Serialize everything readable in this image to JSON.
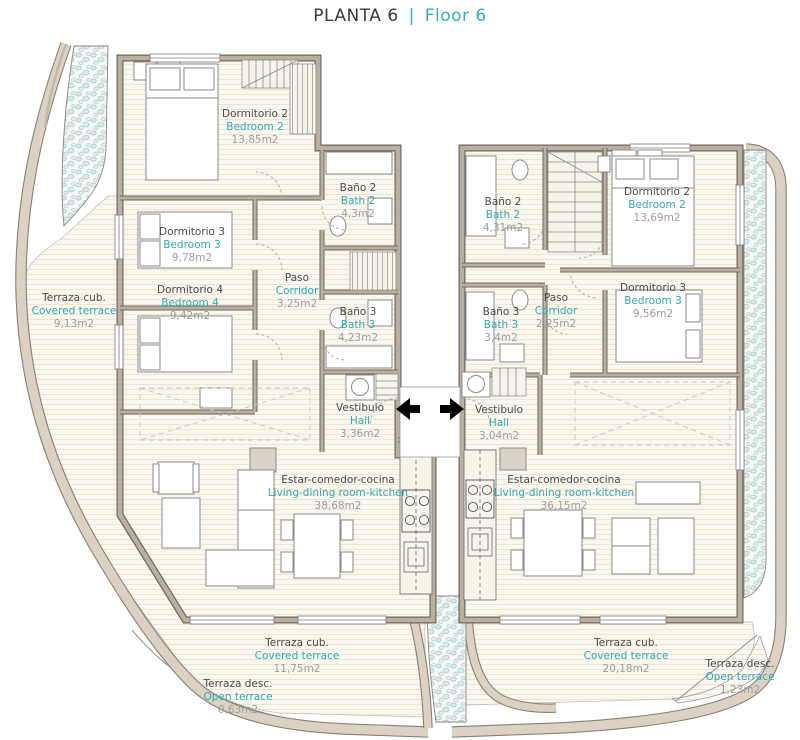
{
  "title": {
    "primary": "PLANTA 6",
    "separator": "|",
    "secondary": "Floor 6"
  },
  "colors": {
    "accent_teal": "#2fa9b2",
    "room_name_gray": "#4a4a4a",
    "area_gray": "#9c9c9c",
    "wall_taupe": "#b9b0a2",
    "band_beige": "#dcd2c3",
    "pebble_blue": "#d9ebe9"
  },
  "icons": {
    "entry_left": "arrow-left",
    "entry_right": "arrow-right"
  },
  "apartment_left": {
    "bedroom2": {
      "es": "Dormitorio 2",
      "en": "Bedroom 2",
      "area": "13,85m2"
    },
    "bedroom3": {
      "es": "Dormitorio 3",
      "en": "Bedroom 3",
      "area": "9,78m2"
    },
    "bedroom4": {
      "es": "Dormitorio 4",
      "en": "Bedroom 4",
      "area": "9,42m2"
    },
    "bath2": {
      "es": "Baño 2",
      "en": "Bath 2",
      "area": "4,3m2"
    },
    "corridor": {
      "es": "Paso",
      "en": "Corridor",
      "area": "3,25m2"
    },
    "bath3": {
      "es": "Baño 3",
      "en": "Bath 3",
      "area": "4,23m2"
    },
    "hall": {
      "es": "Vestibulo",
      "en": "Hall",
      "area": "3,36m2"
    },
    "living": {
      "es": "Estar-comedor-cocina",
      "en": "Living-dining room-kitchen",
      "area": "38,68m2"
    },
    "terrace_side": {
      "es": "Terraza cub.",
      "en": "Covered terrace",
      "area": "9,13m2"
    },
    "terrace_bottom": {
      "es": "Terraza cub.",
      "en": "Covered terrace",
      "area": "11,75m2"
    },
    "terrace_open": {
      "es": "Terraza desc.",
      "en": "Open terrace",
      "area": "0,63m2"
    }
  },
  "apartment_right": {
    "bath2": {
      "es": "Baño 2",
      "en": "Bath 2",
      "area": "4,31m2"
    },
    "bedroom2": {
      "es": "Dormitorio 2",
      "en": "Bedroom 2",
      "area": "13,69m2"
    },
    "bath3": {
      "es": "Baño 3",
      "en": "Bath 3",
      "area": "3,4m2"
    },
    "corridor": {
      "es": "Paso",
      "en": "Corridor",
      "area": "2,25m2"
    },
    "bedroom3": {
      "es": "Dormitorio 3",
      "en": "Bedroom 3",
      "area": "9,56m2"
    },
    "hall": {
      "es": "Vestibulo",
      "en": "Hall",
      "area": "3,04m2"
    },
    "living": {
      "es": "Estar-comedor-cocina",
      "en": "Living-dining room-kitchen",
      "area": "36,15m2"
    },
    "terrace_bottom": {
      "es": "Terraza cub.",
      "en": "Covered terrace",
      "area": "20,18m2"
    },
    "terrace_open": {
      "es": "Terraza desc.",
      "en": "Open terrace",
      "area": "1,23m2"
    }
  }
}
